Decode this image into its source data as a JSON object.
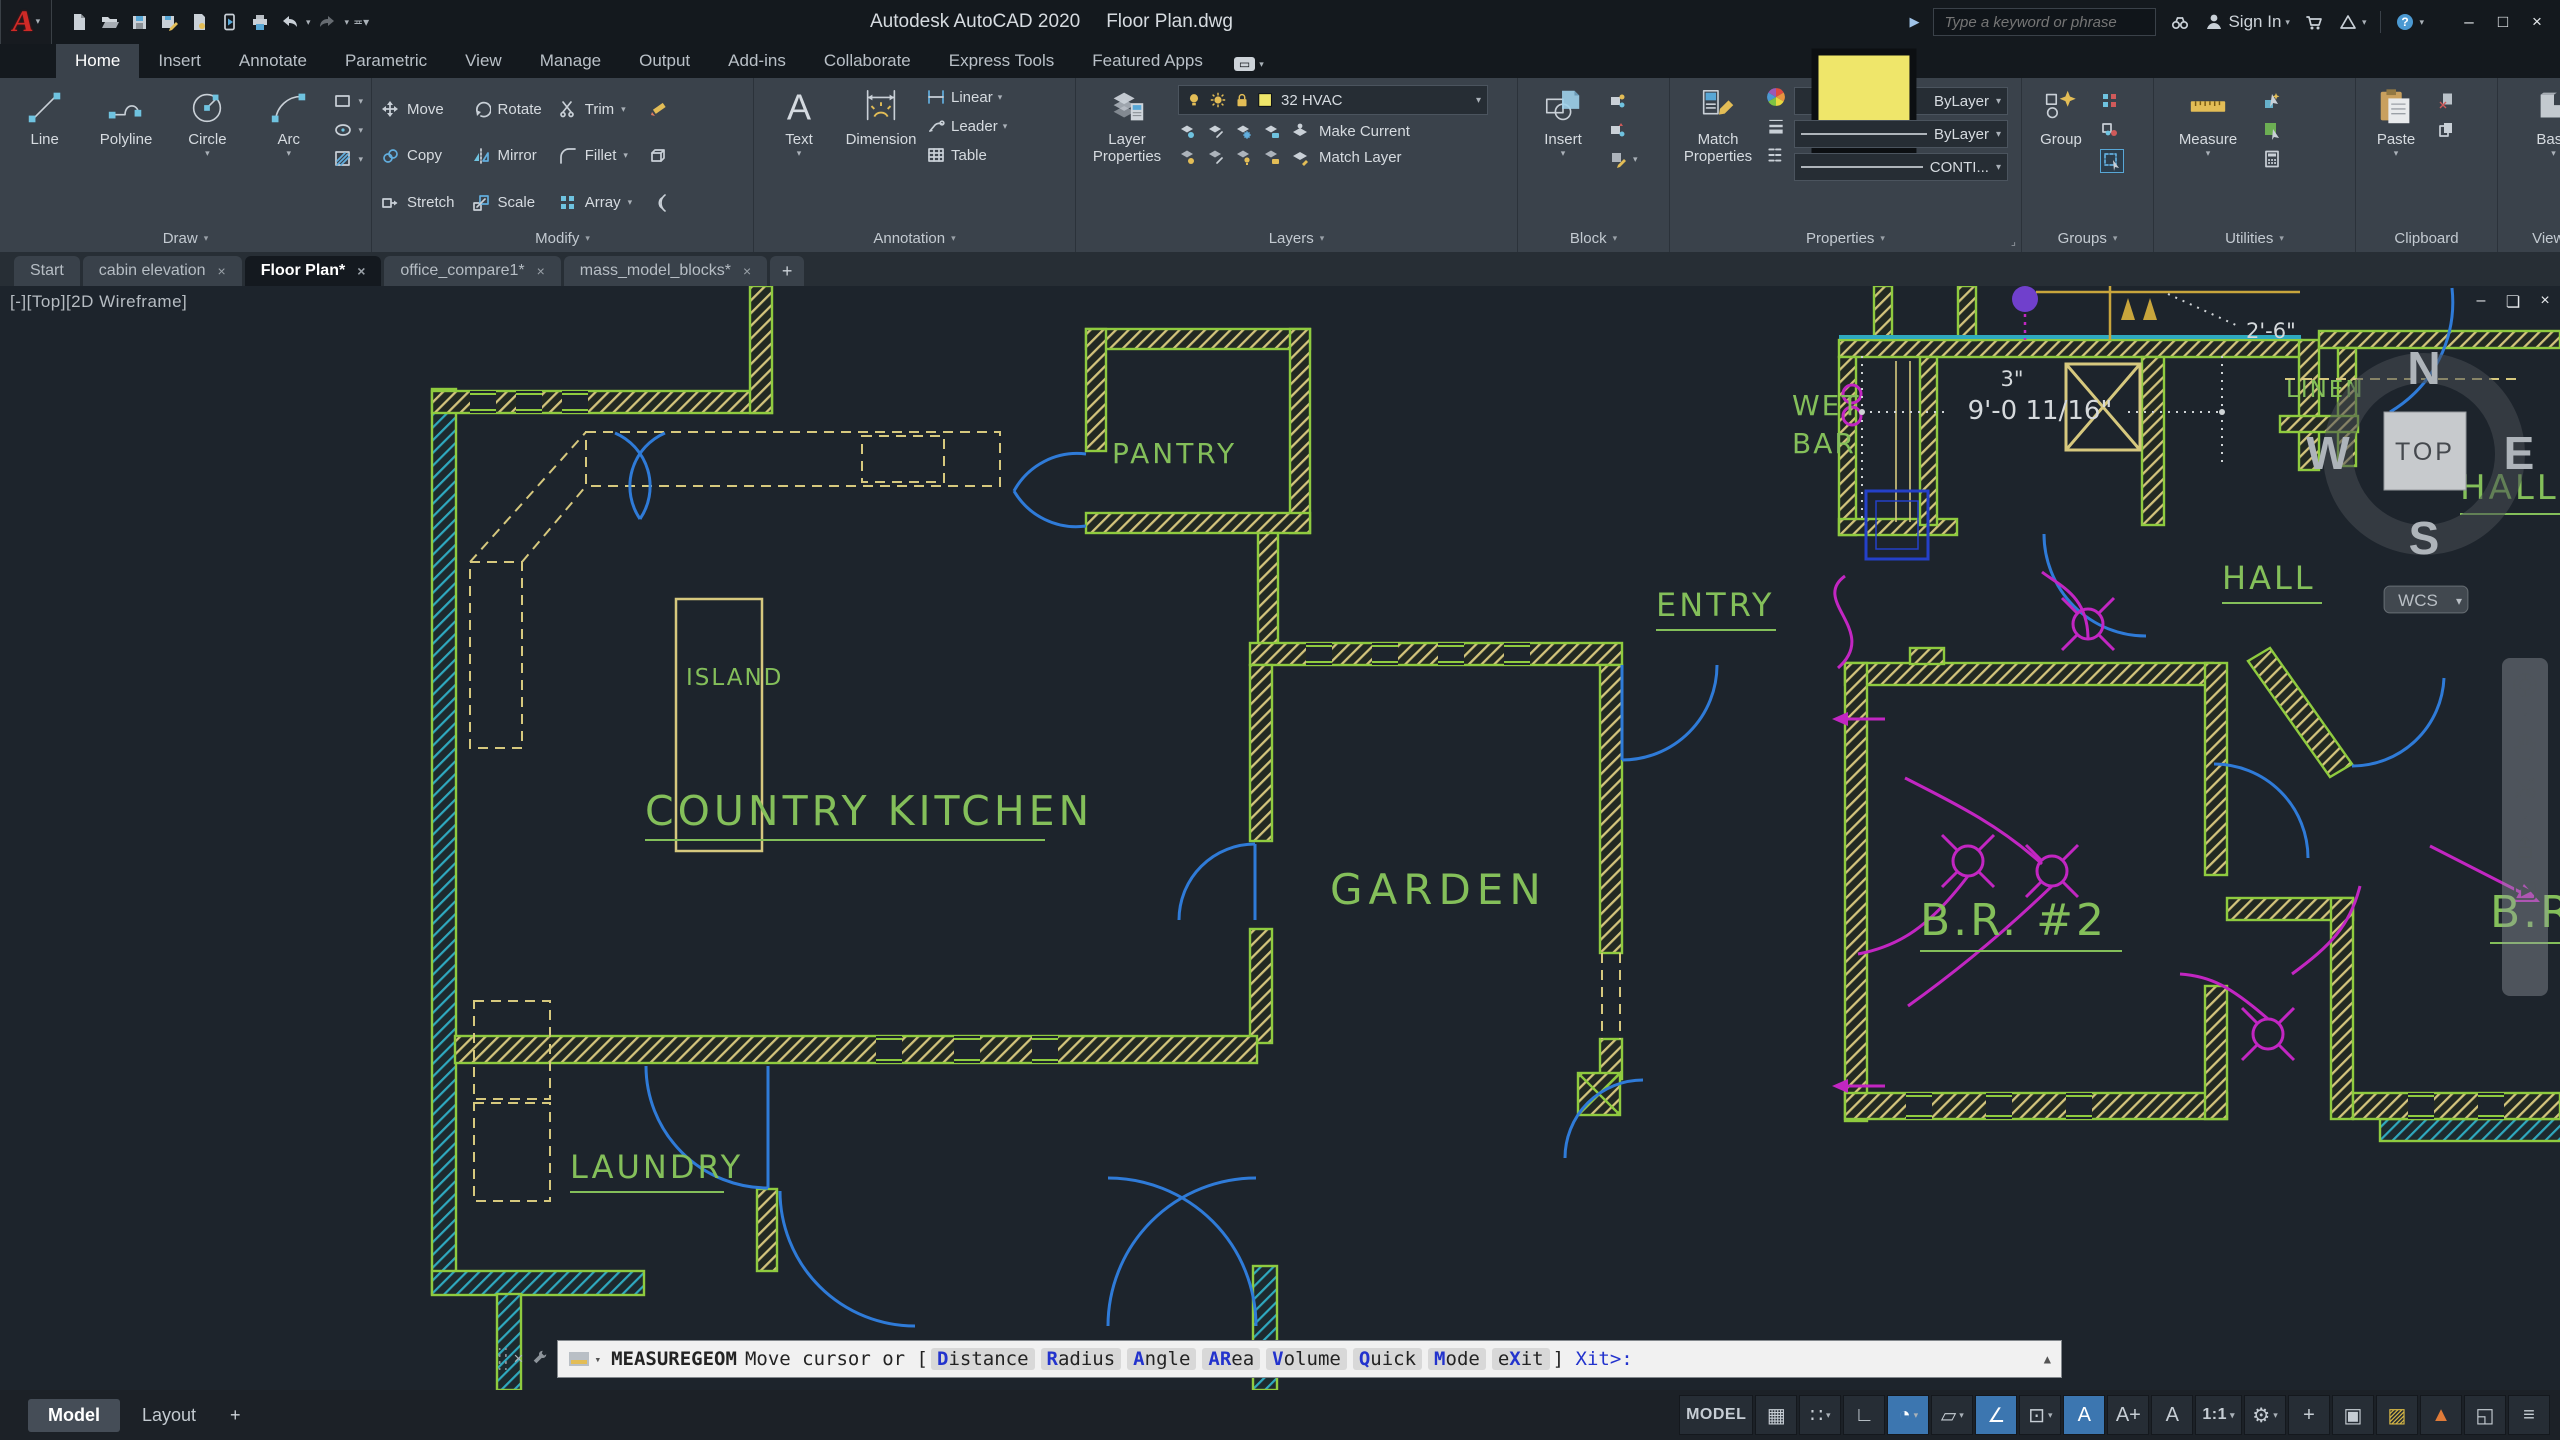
{
  "title_bar": {
    "app_title": "Autodesk AutoCAD 2020",
    "doc_title": "Floor Plan.dwg",
    "search_placeholder": "Type a keyword or phrase",
    "sign_in": "Sign In",
    "quick_access_icons": [
      "new",
      "open",
      "save",
      "save-as",
      "open-from-web",
      "save-to-mobile",
      "plot",
      "undo",
      "redo",
      "customize-quick-access"
    ],
    "right_icons": [
      "search-binoculars",
      "sign-in-user",
      "cart",
      "app-store",
      "help"
    ]
  },
  "ribbon": {
    "tabs": [
      {
        "label": "Home",
        "active": true
      },
      {
        "label": "Insert"
      },
      {
        "label": "Annotate"
      },
      {
        "label": "Parametric"
      },
      {
        "label": "View"
      },
      {
        "label": "Manage"
      },
      {
        "label": "Output"
      },
      {
        "label": "Add-ins"
      },
      {
        "label": "Collaborate"
      },
      {
        "label": "Express Tools"
      },
      {
        "label": "Featured Apps"
      }
    ],
    "panels": {
      "draw": {
        "title": "Draw",
        "line": "Line",
        "polyline": "Polyline",
        "circle": "Circle",
        "arc": "Arc"
      },
      "modify": {
        "title": "Modify",
        "move": "Move",
        "copy": "Copy",
        "stretch": "Stretch",
        "rotate": "Rotate",
        "mirror": "Mirror",
        "scale": "Scale",
        "trim": "Trim",
        "fillet": "Fillet",
        "array": "Array"
      },
      "annotation": {
        "title": "Annotation",
        "text": "Text",
        "dimension": "Dimension",
        "linear": "Linear",
        "leader": "Leader",
        "table": "Table"
      },
      "layers": {
        "title": "Layers",
        "layer_properties": "Layer Properties",
        "current_layer": "32 HVAC",
        "make_current": "Make Current",
        "match_layer": "Match Layer"
      },
      "block": {
        "title": "Block",
        "insert": "Insert"
      },
      "properties": {
        "title": "Properties",
        "match_properties": "Match Properties",
        "color": "ByLayer",
        "lineweight": "ByLayer",
        "linetype": "CONTI..."
      },
      "groups": {
        "title": "Groups",
        "group": "Group"
      },
      "utilities": {
        "title": "Utilities",
        "measure": "Measure"
      },
      "clipboard": {
        "title": "Clipboard",
        "paste": "Paste"
      },
      "view": {
        "title": "View",
        "base": "Base"
      },
      "touch": {
        "title": "Touch",
        "select_mode": "Select Mode"
      }
    }
  },
  "file_tabs": {
    "tabs": [
      {
        "label": "Start",
        "closable": false,
        "active": false
      },
      {
        "label": "cabin elevation",
        "closable": true,
        "active": false
      },
      {
        "label": "Floor Plan*",
        "closable": true,
        "active": true
      },
      {
        "label": "office_compare1*",
        "closable": true,
        "active": false
      },
      {
        "label": "mass_model_blocks*",
        "closable": true,
        "active": false
      }
    ],
    "new_tab": "+"
  },
  "viewport": {
    "label": "[-][Top][2D Wireframe]",
    "controls": [
      "minimize",
      "restore",
      "close"
    ],
    "viewcube": {
      "top": "TOP",
      "n": "N",
      "e": "E",
      "s": "S",
      "w": "W"
    },
    "wcs": "WCS",
    "navbar_icons": [
      "navigation-wheel",
      "pan-hand",
      "zoom-orbit",
      "full-navigation",
      "show-motion"
    ]
  },
  "drawing": {
    "rooms": {
      "pantry": "Pantry",
      "island": "Island",
      "country_kitchen": "Country Kitchen",
      "garden": "Garden",
      "entry": "Entry",
      "laundry": "Laundry",
      "hall": "Hall",
      "br2": "B.R. #2",
      "br_right": "B.R.",
      "wet_bar_1": "Wet",
      "wet_bar_2": "Bar",
      "linen": "Linen",
      "hall_b": "Hall B"
    },
    "dimensions": {
      "d26": "2'-6\"",
      "d3": "3\"",
      "d9": "9'-0 11/16\""
    },
    "colors": {
      "background": "#1d242c",
      "wall_green": "#8fcb3f",
      "hatch_tan": "#d3c47c",
      "hatch_cyan": "#2fa9bf",
      "door_blue": "#2f7bd8",
      "electrical_magenta": "#c226c2",
      "label_green": "#84bf5a",
      "dimension_text": "#d5d9dc"
    }
  },
  "command_line": {
    "macro": "MEASUREGEOM",
    "prompt_pre": "Move cursor or [",
    "options": [
      {
        "pre": "",
        "hot": "D",
        "post": "istance"
      },
      {
        "pre": "",
        "hot": "R",
        "post": "adius"
      },
      {
        "pre": "",
        "hot": "A",
        "post": "ngle"
      },
      {
        "pre": "",
        "hot": "AR",
        "post": "ea"
      },
      {
        "pre": "",
        "hot": "V",
        "post": "olume"
      },
      {
        "pre": "",
        "hot": "Q",
        "post": "uick"
      },
      {
        "pre": "",
        "hot": "M",
        "post": "ode"
      },
      {
        "pre": "e",
        "hot": "X",
        "post": "it"
      }
    ],
    "suffix": {
      "pre": "] <e",
      "hot": "X",
      "post": "it>:"
    }
  },
  "status_bar": {
    "model_tab": "Model",
    "layout_tab": "Layout",
    "new_layout": "+",
    "icons": [
      {
        "name": "model-space-toggle",
        "label": "MODEL"
      },
      {
        "name": "grid-display",
        "glyph": "▦"
      },
      {
        "name": "snap-mode",
        "glyph": "∷",
        "caret": true
      },
      {
        "name": "ortho-mode",
        "glyph": "∟"
      },
      {
        "name": "polar-tracking",
        "glyph": "◔",
        "caret": true,
        "highlight": true
      },
      {
        "name": "isometric-drafting",
        "glyph": "▱",
        "caret": true
      },
      {
        "name": "object-snap-tracking",
        "glyph": "∠",
        "highlight": true
      },
      {
        "name": "object-snap",
        "glyph": "⊡",
        "caret": true
      },
      {
        "name": "annotation-visibility",
        "glyph": "A",
        "highlight": true
      },
      {
        "name": "annotation-autoscale",
        "glyph": "A+"
      },
      {
        "name": "annotation-scale-icon",
        "glyph": "A"
      },
      {
        "name": "annotation-scale",
        "label": "1:1",
        "caret": true
      },
      {
        "name": "workspace-switching",
        "glyph": "⚙",
        "caret": true
      },
      {
        "name": "annotation-monitor",
        "glyph": "+"
      },
      {
        "name": "quick-properties",
        "glyph": "▣"
      },
      {
        "name": "isolate-objects",
        "glyph": "▨",
        "color": "#d9b945"
      },
      {
        "name": "graphics-performance",
        "glyph": "▲",
        "color": "#e07b39"
      },
      {
        "name": "clean-screen",
        "glyph": "◱"
      },
      {
        "name": "customize",
        "glyph": "≡"
      }
    ]
  }
}
